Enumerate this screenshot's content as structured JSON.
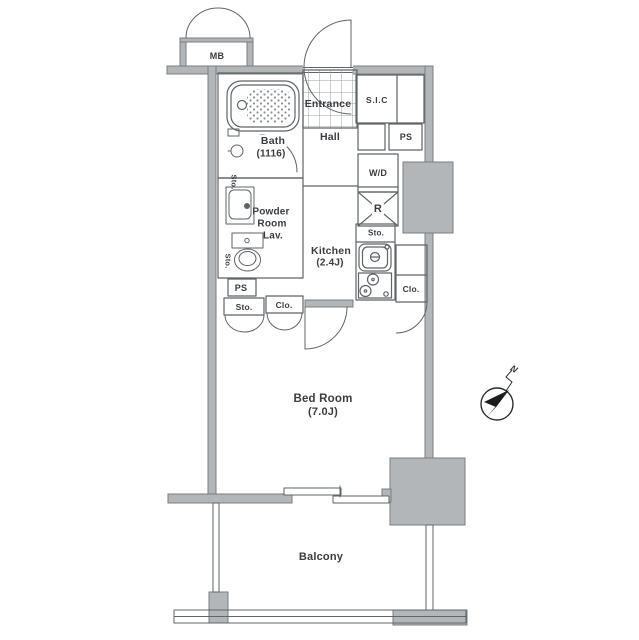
{
  "floorplan": {
    "rooms": {
      "mb": {
        "label": "MB"
      },
      "entrance": {
        "label": "Entrance"
      },
      "sic": {
        "label": "S.I.C"
      },
      "hall": {
        "label": "Hall"
      },
      "bath": {
        "label": "Bath",
        "size": "(1116)"
      },
      "powder_room": {
        "line1": "Powder",
        "line2": "Room",
        "line3": "Lav."
      },
      "kitchen": {
        "label": "Kitchen",
        "size": "(2.4J)"
      },
      "bed_room": {
        "label": "Bed Room",
        "size": "(7.0J)"
      },
      "balcony": {
        "label": "Balcony"
      }
    },
    "fixtures": {
      "ps_upper": "PS",
      "washer_dryer": "W/D",
      "refrigerator": "R",
      "sto_counter": "Sto.",
      "clo_kitchen": "Clo.",
      "ps_lower": "PS",
      "sto_lower": "Sto.",
      "clo_lower": "Clo.",
      "sto_basin": "Sto.",
      "sto_toilet": "Sto."
    },
    "compass": {
      "north": "N"
    },
    "colors": {
      "wall_fill": "#b3b6b8",
      "wall_edge": "#787d80",
      "line": "#5f6568",
      "text": "#3a3d40",
      "background": "#ffffff"
    }
  }
}
